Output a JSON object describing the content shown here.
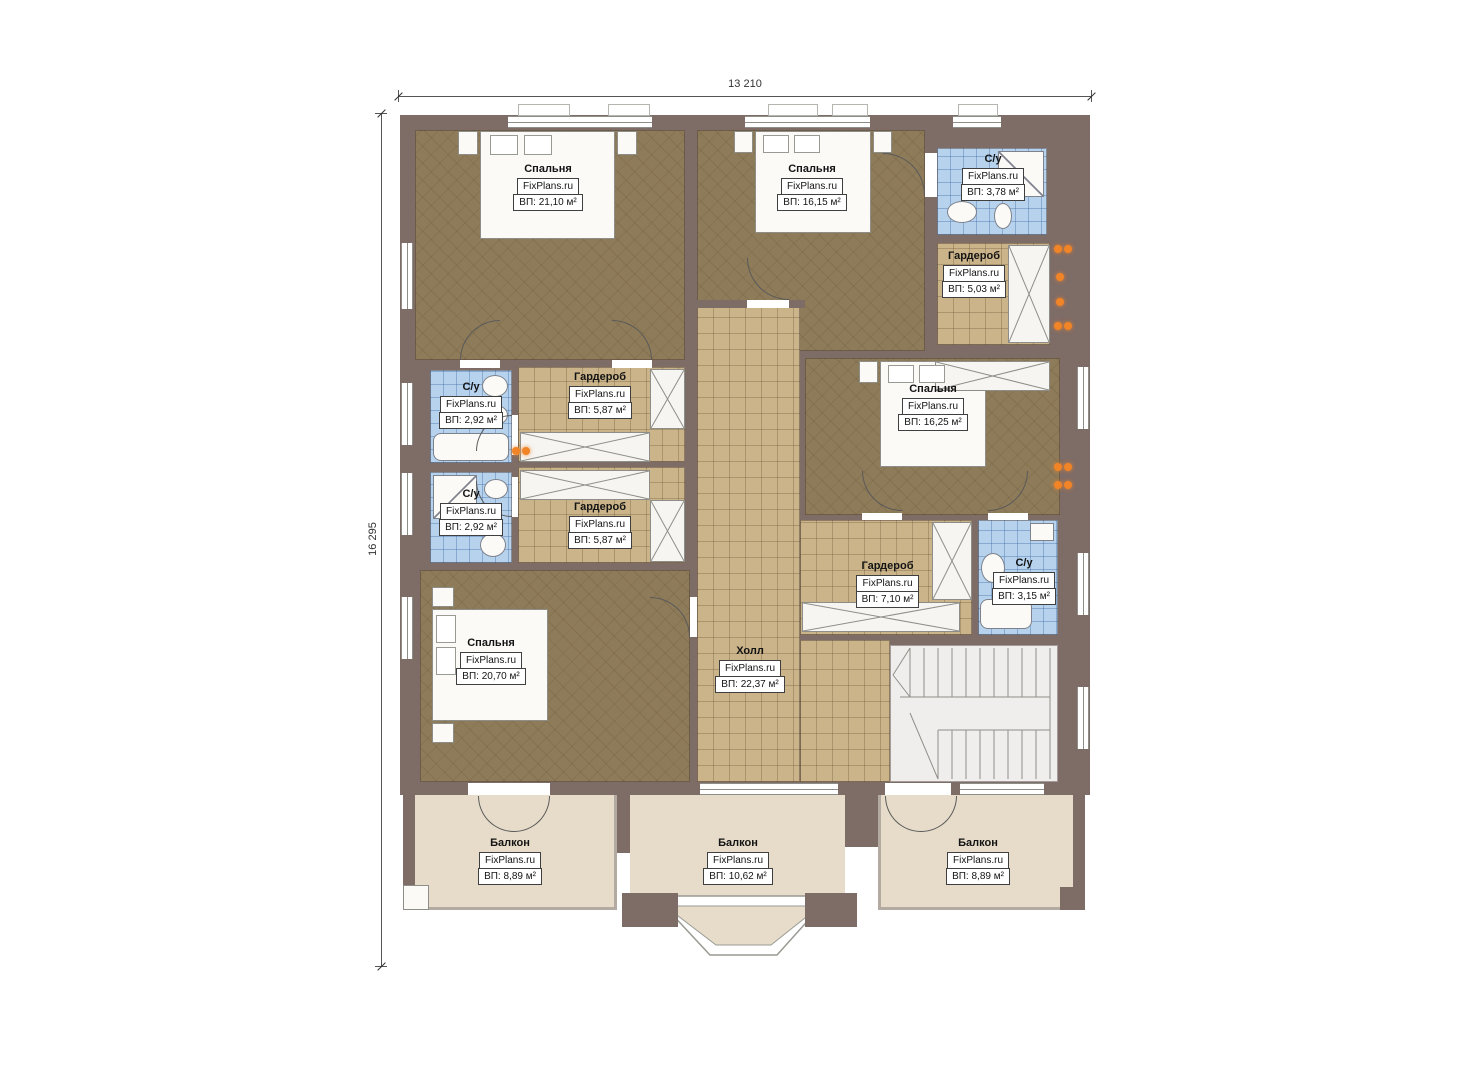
{
  "watermark": "FixPlans.ru",
  "dimensions": {
    "width_mm": "13 210",
    "height_mm": "16 295"
  },
  "colors": {
    "wall": "#7e6c67",
    "bedroom_floor": "#8e7b59",
    "tile_floor": "#cbb48a",
    "bath_floor": "#b6d2ed",
    "balcony_floor": "#e6dcc9",
    "outlet": "#f08427"
  },
  "rooms": {
    "bedroom_tl": {
      "name": "Спальня",
      "area": "ВП: 21,10 м²"
    },
    "bedroom_tm": {
      "name": "Спальня",
      "area": "ВП: 16,15 м²"
    },
    "bath_tr": {
      "name": "С/у",
      "area": "ВП: 3,78 м²"
    },
    "wardrobe_tr": {
      "name": "Гардероб",
      "area": "ВП: 5,03 м²"
    },
    "bedroom_r": {
      "name": "Спальня",
      "area": "ВП: 16,25 м²"
    },
    "bath_l1": {
      "name": "С/у",
      "area": "ВП: 2,92 м²"
    },
    "bath_l2": {
      "name": "С/у",
      "area": "ВП: 2,92 м²"
    },
    "wardrobe_m1": {
      "name": "Гардероб",
      "area": "ВП: 5,87 м²"
    },
    "wardrobe_m2": {
      "name": "Гардероб",
      "area": "ВП: 5,87 м²"
    },
    "bedroom_bl": {
      "name": "Спальня",
      "area": "ВП: 20,70 м²"
    },
    "hall": {
      "name": "Холл",
      "area": "ВП: 22,37 м²"
    },
    "wardrobe_br": {
      "name": "Гардероб",
      "area": "ВП: 7,10 м²"
    },
    "bath_br": {
      "name": "С/у",
      "area": "ВП: 3,15 м²"
    },
    "balcony_l": {
      "name": "Балкон",
      "area": "ВП: 8,89 м²"
    },
    "balcony_m": {
      "name": "Балкон",
      "area": "ВП: 10,62 м²"
    },
    "balcony_r": {
      "name": "Балкон",
      "area": "ВП: 8,89 м²"
    }
  }
}
